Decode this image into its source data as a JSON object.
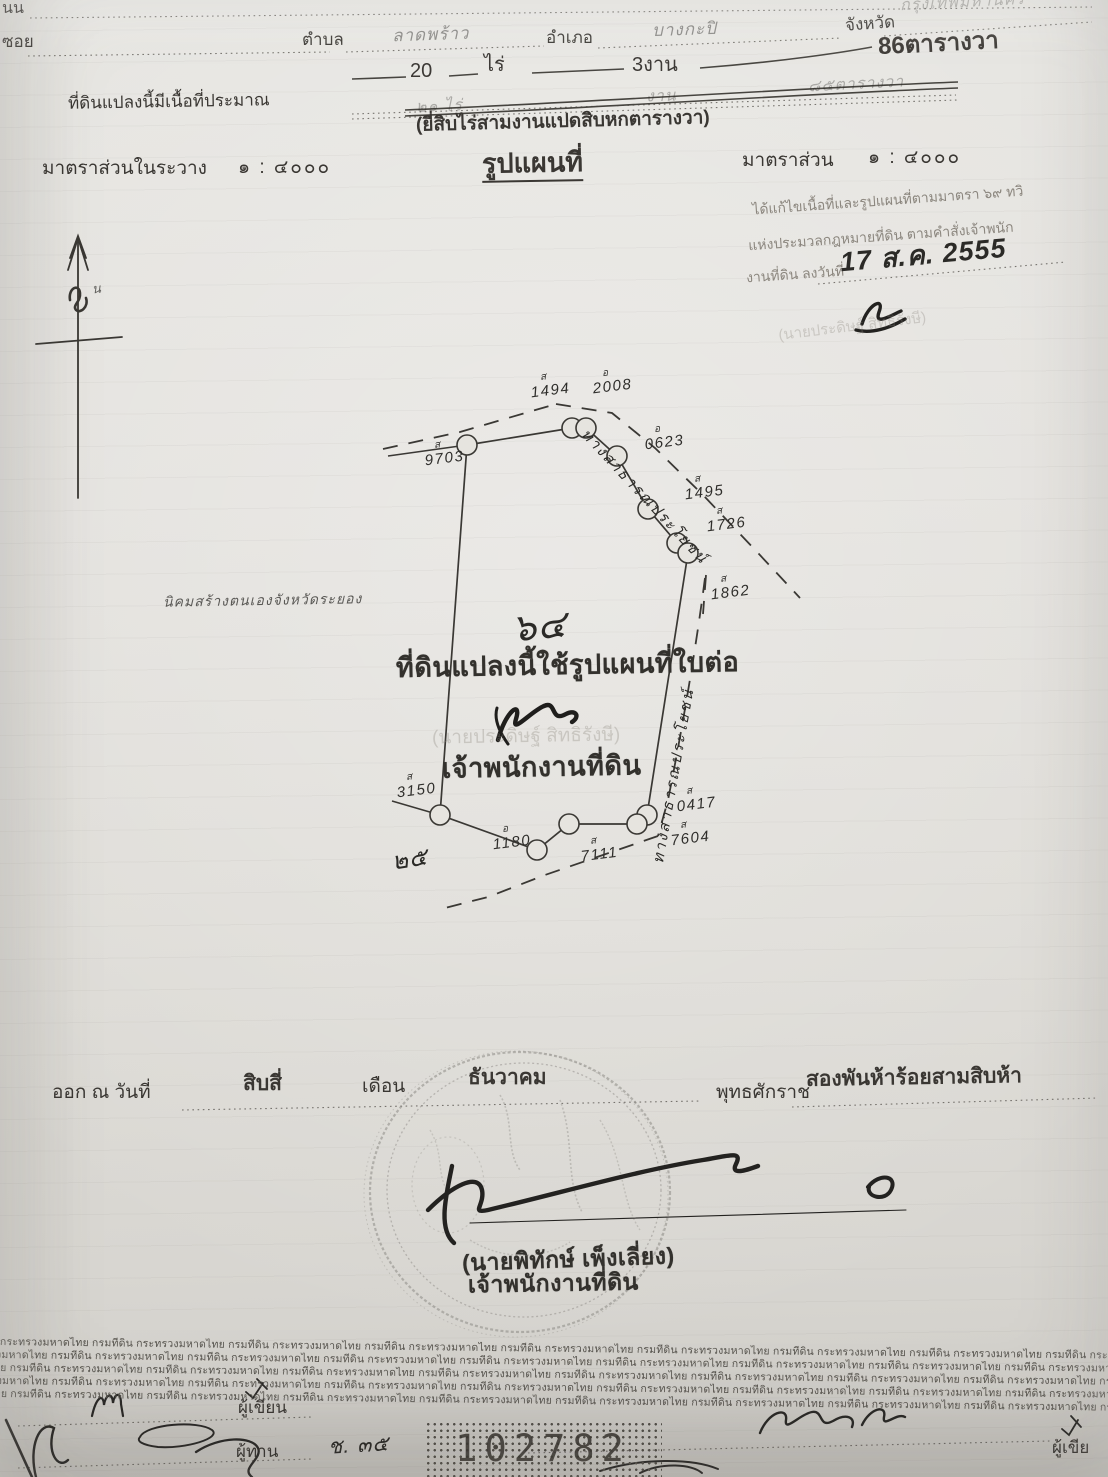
{
  "doc": {
    "header": {
      "road_label": "นน",
      "soi_label": "ซอย",
      "tambon_label": "ตำบล",
      "tambon_value": "ลาดพร้าว",
      "amphoe_label": "อำเภอ",
      "amphoe_value": "บางกะปิ",
      "changwat_label": "จังหวัด",
      "changwat_value": "กรุงเทพมหานคร",
      "area_wa": "86ตารางวา",
      "area_rai": "20",
      "rai_unit": "ไร่",
      "area_ngan": "3งาน",
      "approx_label": "ที่ดินแปลงนี้มีเนื้อที่ประมาณ",
      "struck_rai": "๒๑ ไร่",
      "struck_ngan": "งาน",
      "struck_wa": "๘๕ตารางวา",
      "area_in_words": "(ยี่สิบไร่สามงานแปดสิบหกตารางวา)"
    },
    "scale": {
      "left_label": "มาตราส่วนในระวาง",
      "left_value": "๑ : ๔๐๐๐",
      "title": "รูปแผนที่",
      "right_label": "มาตราส่วน",
      "right_value": "๑ : ๔๐๐๐"
    },
    "amendment": {
      "line1": "ได้แก้ไขเนื้อที่และรูปแผนที่ตามมาตรา ๖๙ ทวิ",
      "line2": "แห่งประมวลกฎหมายที่ดิน ตามคำสั่งเจ้าพนัก",
      "line3": "งานที่ดิน ลงวันที่",
      "date": "17 ส.ค. 2555",
      "signer": "(นายประดิษฐ์  สิทธิรังษี)"
    },
    "compass": {
      "letter": "น"
    },
    "map": {
      "settlement_note": "นิคมสร้างตนเองจังหวัดระยอง",
      "parcel_no": "๖๔",
      "stamp_line": "ที่ดินแปลงนี้ใช้รูปแผนที่ใบต่อ",
      "signer_name": "(นายประดิษฐ์  สิทธิรังษี)",
      "signer_title": "เจ้าพนักงานที่ดิน",
      "road_ne": "ทางสาธารณประโยชน์",
      "road_east": "ทางสาธารณประโยชน์",
      "margin_note": "๒๕",
      "markers": [
        {
          "pfx": "ส",
          "num": "1494"
        },
        {
          "pfx": "อ",
          "num": "2008"
        },
        {
          "pfx": "ส",
          "num": "9703"
        },
        {
          "pfx": "อ",
          "num": "0623"
        },
        {
          "pfx": "ส",
          "num": "1495"
        },
        {
          "pfx": "ส",
          "num": "1726"
        },
        {
          "pfx": "ส",
          "num": "1862"
        },
        {
          "pfx": "ส",
          "num": "0417"
        },
        {
          "pfx": "ส",
          "num": "7604"
        },
        {
          "pfx": "ส",
          "num": "7111"
        },
        {
          "pfx": "อ",
          "num": "1180"
        },
        {
          "pfx": "ส",
          "num": "3150"
        }
      ]
    },
    "issue": {
      "prefix": "ออก ณ วันที่",
      "day": "สิบสี่",
      "month_label": "เดือน",
      "month": "ธันวาคม",
      "era_label": "พุทธศักราช",
      "year": "สองพันห้าร้อยสามสิบห้า"
    },
    "seal": {
      "name": "(นายพิทักษ์  เพ็งเลี่ยง)",
      "title": "เจ้าพนักงานที่ดิน"
    },
    "watermark": {
      "text": "กระทรวงมหาดไทย  กรมที่ดิน",
      "rows": 5,
      "reps": 9
    },
    "footer": {
      "writer_label": "ผู้เขียน",
      "proof_label": "ผู้ทาน",
      "code": "ช. ๓๕",
      "serial": "102782",
      "writer2_label": "ผู้เขีย"
    }
  }
}
